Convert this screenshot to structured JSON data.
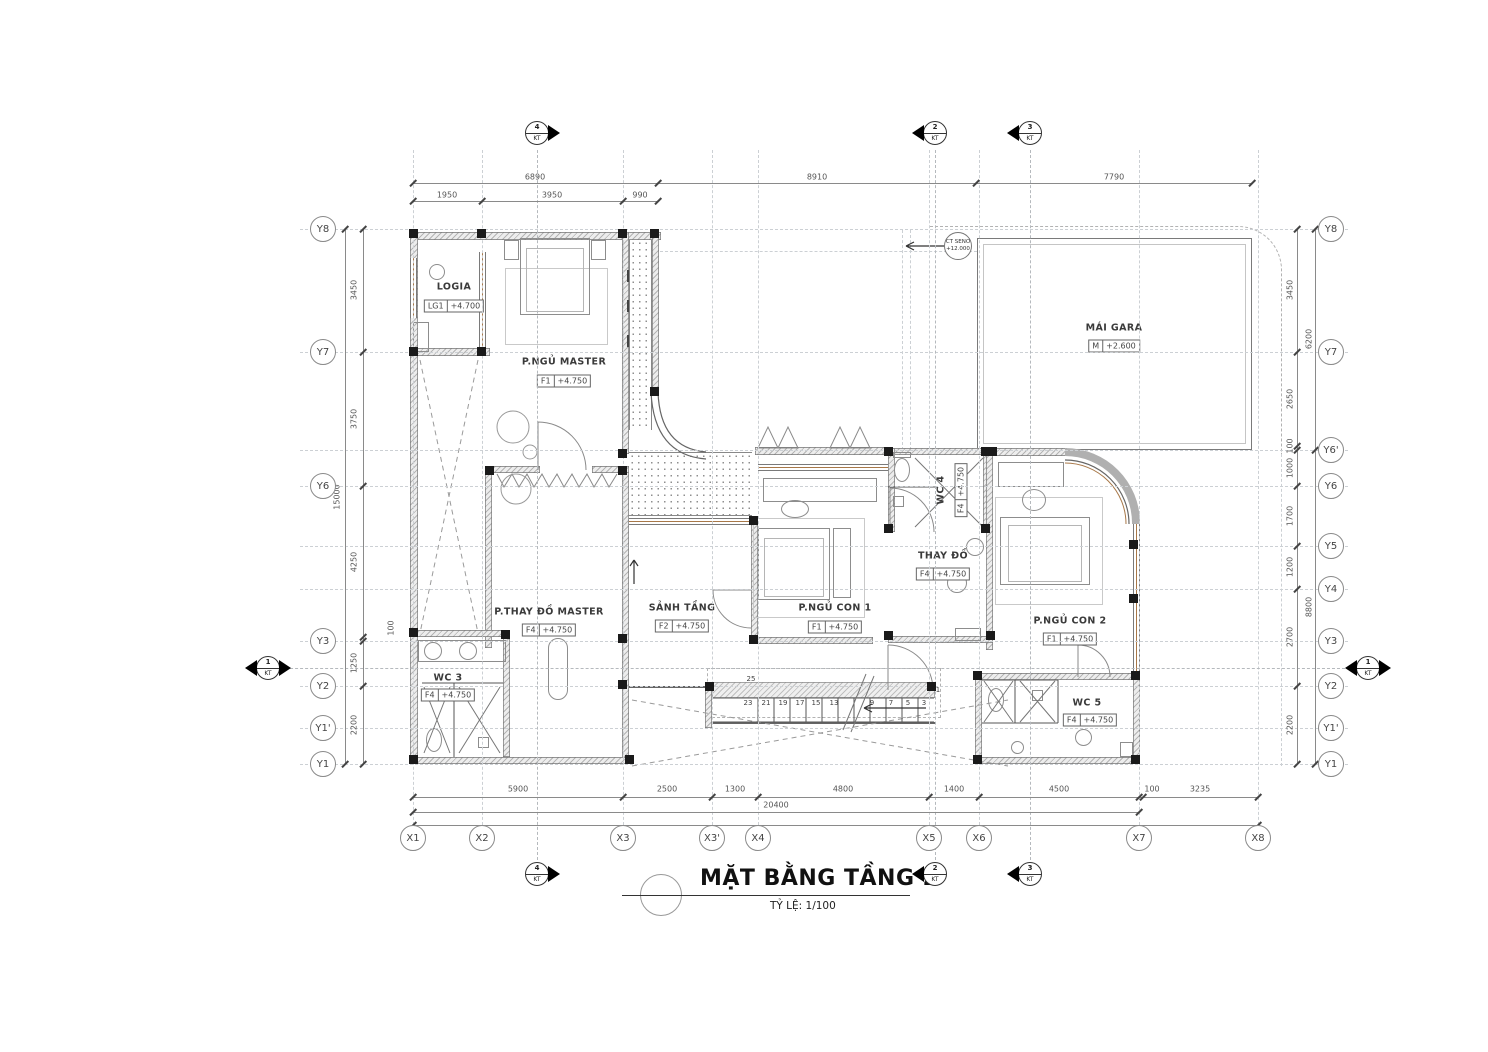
{
  "title_block": {
    "title": "MẶT BẰNG TẦNG 2",
    "scale_label": "TỶ LỆ: 1/100"
  },
  "rooms": [
    {
      "name": "LOGIA",
      "tag": "LG1",
      "level": "+4.700"
    },
    {
      "name": "P.NGỦ MASTER",
      "tag": "F1",
      "level": "+4.750"
    },
    {
      "name": "MÁI GARA",
      "tag": "M",
      "level": "+2.600"
    },
    {
      "name": "P.THAY ĐỒ MASTER",
      "tag": "F4",
      "level": "+4.750"
    },
    {
      "name": "SẢNH TẦNG",
      "tag": "F2",
      "level": "+4.750"
    },
    {
      "name": "WC 3",
      "tag": "F4",
      "level": "+4.750"
    },
    {
      "name": "P.NGỦ CON 1",
      "tag": "F1",
      "level": "+4.750"
    },
    {
      "name": "WC 4",
      "tag": "F4",
      "level": "+4.750"
    },
    {
      "name": "THAY ĐỒ",
      "tag": "F4",
      "level": "+4.750"
    },
    {
      "name": "P.NGỦ CON 2",
      "tag": "F1",
      "level": "+4.750"
    },
    {
      "name": "WC 5",
      "tag": "F4",
      "level": "+4.750"
    }
  ],
  "callout": {
    "line1": "CT SENO",
    "line2": "+12.000"
  },
  "axes": {
    "x": [
      "X1",
      "X2",
      "X3",
      "X3'",
      "X4",
      "X5",
      "X6",
      "X7",
      "X8"
    ],
    "y_left": [
      "Y8",
      "Y7",
      "Y6",
      "Y3",
      "Y2",
      "Y1'",
      "Y1"
    ],
    "y_right": [
      "Y8",
      "Y7",
      "Y6'",
      "Y6",
      "Y5",
      "Y4",
      "Y3",
      "Y2",
      "Y1'",
      "Y1"
    ]
  },
  "dimensions": {
    "top_row1": [
      "6890",
      "8910",
      "7790"
    ],
    "top_row2": [
      "1950",
      "3950",
      "990"
    ],
    "bottom": [
      "5900",
      "2500",
      "1300",
      "4800",
      "1400",
      "4500",
      "100",
      "3235"
    ],
    "bottom_total": "20400",
    "left": [
      "3450",
      "3750",
      "4250",
      "100",
      "1250",
      "2200"
    ],
    "left_total": "15000",
    "right": [
      "3450",
      "2650",
      "100",
      "1000",
      "1700",
      "1200",
      "2700",
      "2200"
    ],
    "right_outer": [
      "6200",
      "8800"
    ]
  },
  "stairs": {
    "numbers": [
      "25",
      "23",
      "21",
      "19",
      "17",
      "15",
      "13",
      "9",
      "7",
      "5",
      "3",
      "1"
    ]
  },
  "section_markers": [
    {
      "num": "4",
      "sub": "KT"
    },
    {
      "num": "2",
      "sub": "KT"
    },
    {
      "num": "3",
      "sub": "KT"
    },
    {
      "num": "1",
      "sub": "KT"
    }
  ]
}
